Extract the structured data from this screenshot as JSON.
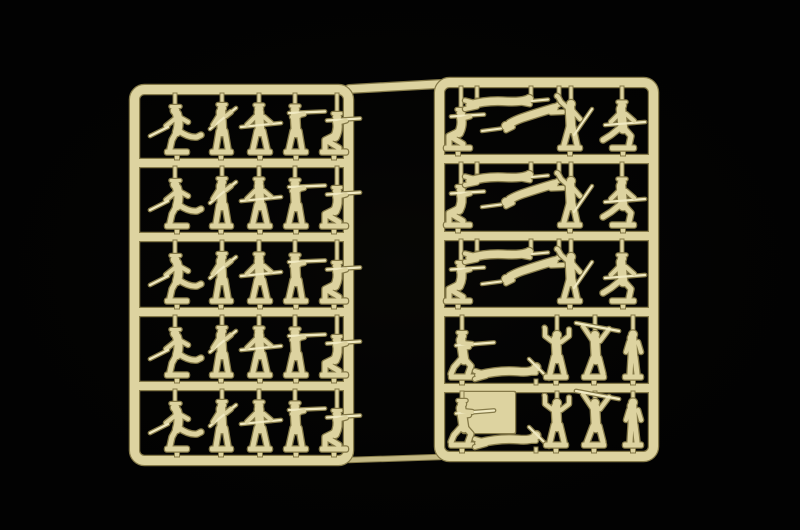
{
  "scene": {
    "type": "photograph",
    "description": "Two cream-coloured injection-moulded plastic sprues of 1/72 scale toy soldier model figures photographed on a black background",
    "background_color": "#020202",
    "vignette_center_tint": "rgba(32,30,20,0.16)",
    "palette": {
      "plastic_cream": "#ddd3a0",
      "plastic_light": "#f0e9c1",
      "plastic_mid": "#c4b985",
      "plastic_shadow": "#857a49"
    },
    "figure_counts": {
      "left_sprue": 25,
      "right_sprue": 25,
      "total": 50
    }
  },
  "image_size": {
    "width": 800,
    "height": 530
  },
  "row_templates": {
    "infantry_line": [
      {
        "pose": "officer-sword",
        "cx": 177
      },
      {
        "pose": "rifle-port",
        "cx": 221
      },
      {
        "pose": "rifle-waist",
        "cx": 261
      },
      {
        "pose": "rifle-firing",
        "cx": 301
      },
      {
        "pose": "rifle-kneeling",
        "cx": 336
      }
    ],
    "prone_group": [
      {
        "pose": "rifle-kneeling",
        "cx": 460
      },
      {
        "pose": "prone-flat",
        "cx": 505,
        "dy": 3
      },
      {
        "pose": "prone-diagonal",
        "cx": 523,
        "dy": 12
      },
      {
        "pose": "grenade-thrower",
        "cx": 571
      },
      {
        "pose": "rifle-runner",
        "cx": 624
      }
    ],
    "assault_group": [
      {
        "pose": "hip-firing",
        "cx": 469
      },
      {
        "pose": "prone-crawler",
        "cx": 511
      },
      {
        "pose": "hands-up",
        "cx": 557
      },
      {
        "pose": "rifle-overhead",
        "cx": 597
      },
      {
        "pose": "attention",
        "cx": 633
      }
    ]
  },
  "sprues": [
    {
      "id": "left-sprue",
      "frame": {
        "x": 130,
        "y": 85,
        "width": 223,
        "height": 380,
        "bar": 9,
        "radius": 10
      },
      "rails_y": [
        159,
        233,
        308,
        382
      ],
      "rows": [
        "infantry_line",
        "infantry_line",
        "infantry_line",
        "infantry_line",
        "infantry_line"
      ]
    },
    {
      "id": "right-sprue",
      "frame": {
        "x": 435,
        "y": 78,
        "width": 223,
        "height": 383,
        "bar": 9,
        "radius": 10
      },
      "rails_y": [
        155,
        232,
        308,
        384
      ],
      "rows": [
        "prone_group",
        "prone_group",
        "prone_group",
        "assault_group",
        "assault_group"
      ],
      "blank_tab": {
        "x": 463,
        "y": 392,
        "width": 52,
        "height": 41
      }
    }
  ],
  "connectors": {
    "top_runner": {
      "x1": 349,
      "y1": 89,
      "x2": 440,
      "y2": 84
    },
    "bottom_runner": {
      "x1": 349,
      "y1": 460,
      "x2": 440,
      "y2": 457
    }
  },
  "poses": {
    "officer-sword": {
      "w": 56,
      "h": 52,
      "mode": "stand",
      "head_dx": -2,
      "base_dx": 0,
      "desc": "officer charging with drawn sabre"
    },
    "rifle-port": {
      "w": 40,
      "h": 54,
      "mode": "stand",
      "head_dx": 1,
      "base_dx": 0,
      "desc": "rifleman standing, rifle across chest"
    },
    "rifle-waist": {
      "w": 46,
      "h": 53,
      "mode": "stand",
      "head_dx": -2,
      "base_dx": -1,
      "desc": "rifleman advancing, rifle at waist"
    },
    "rifle-firing": {
      "w": 50,
      "h": 52,
      "mode": "stand",
      "head_dx": -6,
      "base_dx": -5,
      "desc": "rifleman standing firing"
    },
    "rifle-kneeling": {
      "w": 48,
      "h": 46,
      "mode": "stand",
      "head_dx": 1,
      "base_dx": -2,
      "desc": "rifleman kneeling firing"
    },
    "grenade-thrower": {
      "w": 48,
      "h": 57,
      "mode": "stand",
      "head_dx": 0,
      "base_dx": -1,
      "desc": "grenadier throwing, rifle held upright"
    },
    "rifle-runner": {
      "w": 52,
      "h": 52,
      "mode": "stand",
      "head_dx": -2,
      "base_dx": -1,
      "desc": "rifleman running with rifle levelled"
    },
    "prone-flat": {
      "w": 86,
      "h": 24,
      "mode": "top",
      "hang": [
        [
          -28,
          12
        ],
        [
          26,
          10
        ]
      ],
      "desc": "prone rifleman, head to the right"
    },
    "prone-diagonal": {
      "w": 82,
      "h": 34,
      "mode": "top",
      "hang": [
        [
          36,
          18
        ]
      ],
      "desc": "prone rifleman angled, head to lower left"
    },
    "hip-firing": {
      "w": 52,
      "h": 53,
      "mode": "stand",
      "head_dx": -7,
      "base_dx": -7,
      "desc": "soldier firing from the hip"
    },
    "prone-crawler": {
      "w": 78,
      "h": 26,
      "mode": "bottom",
      "base_dx": 25,
      "desc": "soldier crawling prone"
    },
    "hands-up": {
      "w": 44,
      "h": 55,
      "mode": "stand",
      "head_dx": 0,
      "base_dx": -1,
      "desc": "soldier with both arms raised"
    },
    "rifle-overhead": {
      "w": 50,
      "h": 58,
      "mode": "stand",
      "head_dx": -2,
      "base_dx": -3,
      "desc": "soldier waving rifle overhead"
    },
    "attention": {
      "w": 36,
      "h": 51,
      "mode": "stand",
      "head_dx": 0,
      "base_dx": 0,
      "desc": "soldier standing at attention"
    }
  }
}
